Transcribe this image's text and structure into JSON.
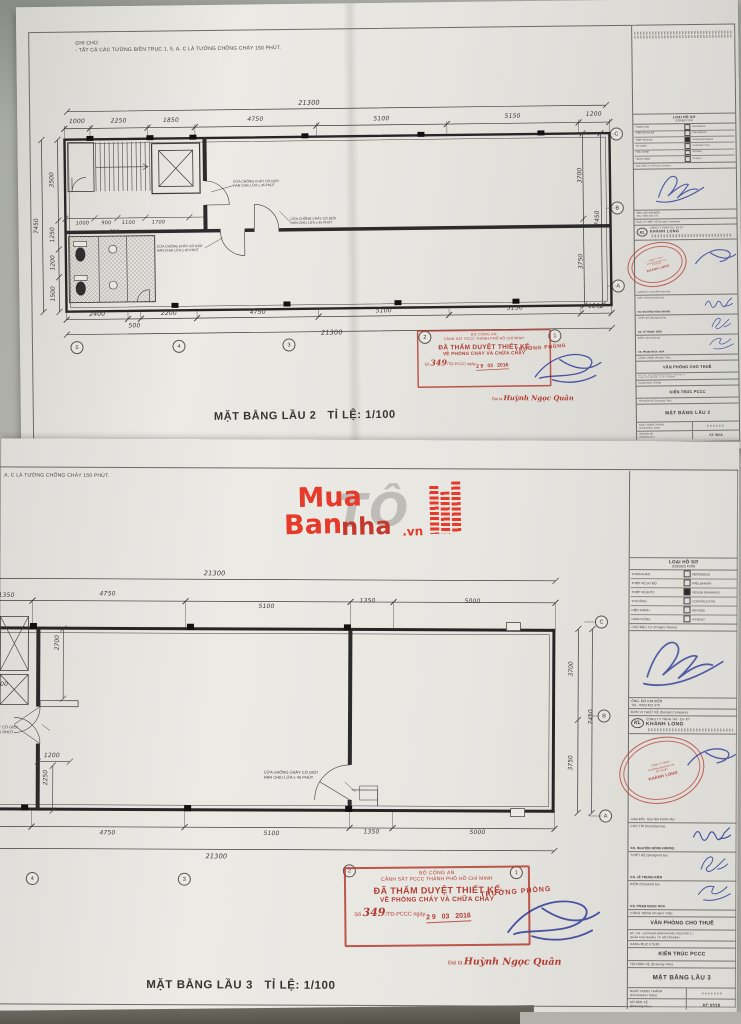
{
  "colors": {
    "stamp_red": "#b03c30",
    "signature_blue": "#2d3a96",
    "watermark_red": "#e63a2a",
    "paper": "#e8e6e1",
    "line": "#3a3a3a"
  },
  "note": {
    "heading": "GHI CHÚ:",
    "body": "- TẤT CẢ CÁC TƯỜNG BIÊN TRỤC 1, 5, A, C LÀ TƯỜNG CHỐNG CHÁY 150 PHÚT.",
    "body_cut": "A, C LÀ TƯỜNG CHỐNG CHÁY 150 PHÚT."
  },
  "notes": {
    "fire1": "CỬA CHỐNG CHÁY CÓ GIỚI",
    "fire2": "HẠN CHỊU LỬA ≥ 45 PHÚT"
  },
  "captions": {
    "floor2": "MẶT BẰNG LẦU 2   TỈ LỆ: 1/100",
    "floor3": "MẶT BẰNG LẦU 3   TỈ LỆ: 1/100"
  },
  "watermark": {
    "w1": "Mua",
    "w2": "Ban",
    "w3": "nha",
    "w4": ".vn",
    "ghost": "TÔ"
  },
  "stamp": {
    "agency": "BỘ CÔNG AN",
    "dept": "CẢNH SÁT PCCC THÀNH PHỐ HỒ CHÍ MINH",
    "approved1": "ĐÃ THẨM DUYỆT THIẾT KẾ",
    "approved2": "VỀ PHÒNG CHÁY VÀ CHỮA CHÁY",
    "no_prefix": "Số",
    "number": "349",
    "no_suffix": "/TD-PCCC ngày",
    "date": "2 9   03   2016",
    "chief_title": "TRƯỞNG PHÒNG",
    "signer_rank": "Đại tá",
    "signer_name": "Huỳnh Ngọc Quân"
  },
  "plan2": {
    "dim_total_top": "21300",
    "dims_top": [
      "1000",
      "2250",
      "1850",
      "4750",
      "5100",
      "5150",
      "1200"
    ],
    "dims_bottom": [
      "2400",
      "500",
      "2200",
      "4750",
      "5100",
      "5150",
      "1200"
    ],
    "dim_total_bottom": "21300",
    "dims_left": [
      "3500",
      "1250",
      "1200",
      "1500"
    ],
    "dim_left_total": "7450",
    "dims_right": [
      "3700",
      "3750"
    ],
    "dim_right_total": "7450",
    "dims_inner": [
      "1000",
      "900",
      "1100",
      "1700",
      "250"
    ],
    "grid_cols": [
      "5",
      "4",
      "3",
      "2",
      "1"
    ],
    "grid_rows": [
      "C",
      "B",
      "A"
    ]
  },
  "plan3": {
    "dim_total_top": "21300",
    "dims_top": [
      "1350",
      "4750",
      "5100",
      "1350",
      "5000"
    ],
    "dims_bottom": [
      "4750",
      "5100",
      "1350",
      "5000"
    ],
    "dim_total_bottom": "21300",
    "dims_right": [
      "3700",
      "3750"
    ],
    "dim_right_total": "7450",
    "dims_inner": [
      "2700",
      "1200",
      "2250",
      "00"
    ],
    "grid_cols": [
      "4",
      "3",
      "2",
      "1"
    ],
    "grid_rows": [
      "C",
      "B",
      "A"
    ]
  },
  "titleblock": {
    "issued_vn": "LOẠI HỒ SƠ",
    "issued_en": "(ISSUED FOR)",
    "rows": [
      {
        "vn": "THAM KHẢO",
        "en": "REFERENCE",
        "checked": false
      },
      {
        "vn": "THIẾT KẾ SƠ BỘ",
        "en": "PRELIMINARY",
        "checked": false
      },
      {
        "vn": "THIẾT KẾ BVTC",
        "en": "DESIGN DRAWINGS",
        "checked": true
      },
      {
        "vn": "THI CÔNG",
        "en": "CONSTRUCTION",
        "checked": false
      },
      {
        "vn": "HIỆU CHỈNH",
        "en": "REVISED",
        "checked": false
      },
      {
        "vn": "HOÀN CÔNG",
        "en": "AS-BUILT",
        "checked": false
      }
    ],
    "owner_header": "CHỦ ĐẦU TƯ (Project Owner)",
    "owner_name": "ÔNG: BÙI KIM BIÊN",
    "owner_tel": "TEL: 0903 402 575",
    "design_header": "ĐƠN VỊ THIẾT KẾ (Design Company)",
    "company_logo": "KL",
    "company_line1": "CÔNG TY TNHH TM - DV KT",
    "company_line2": "KHÁNH LONG",
    "company_stamp_l1": "CÔNG TY TNHH",
    "company_stamp_l2": "THƯƠNG MẠI DỊCH VỤ",
    "company_stamp_l3": "KỸ THUẬT",
    "company_stamp_l4": "KHÁNH LONG",
    "director": "GIÁM ĐỐC: NGUYỄN PHAN VÂN",
    "presided_label": "CHỦ TRÌ (Presided by)",
    "presided_name": "KS. NGUYỄN HỒNG NHUNG",
    "designed_label": "THIẾT KẾ (Designed by)",
    "designed_name": "KS. LÊ TRUNG KIÊN",
    "checked_label": "KIỂM (Checked by)",
    "checked_name": "KS. PHẠM NGỌC HÒA",
    "project_label": "CÔNG TRÌNH (Project Title)",
    "project_name": "VĂN PHÒNG CHO THUÊ",
    "project_addr1": "ĐC: 141 - 143 PHAN ĐÌNH PHÙNG, PHƯỜNG 17,",
    "project_addr2": "QUẬN PHÚ NHUẬN, TP. HỒ CHÍ MINH",
    "item_label": "HẠNG MỤC (ITEM)",
    "item_name": "KIẾN TRÚC PCCC",
    "drawing_label": "TÊN BẢN VẼ (Drawing Title)",
    "drawing_name_f2": "MẶT BẰNG LẦU 2",
    "drawing_name_f3": "MẶT BẰNG LẦU 3",
    "date_label1": "NGÀY HOÀN THÀNH",
    "date_label2": "(Completion Date)",
    "no_label1": "SỐ BẢN VẼ",
    "no_label2": "(Drawing No.)",
    "no_f2": "KT: 06/18",
    "no_f3": "KT: 07/18"
  }
}
